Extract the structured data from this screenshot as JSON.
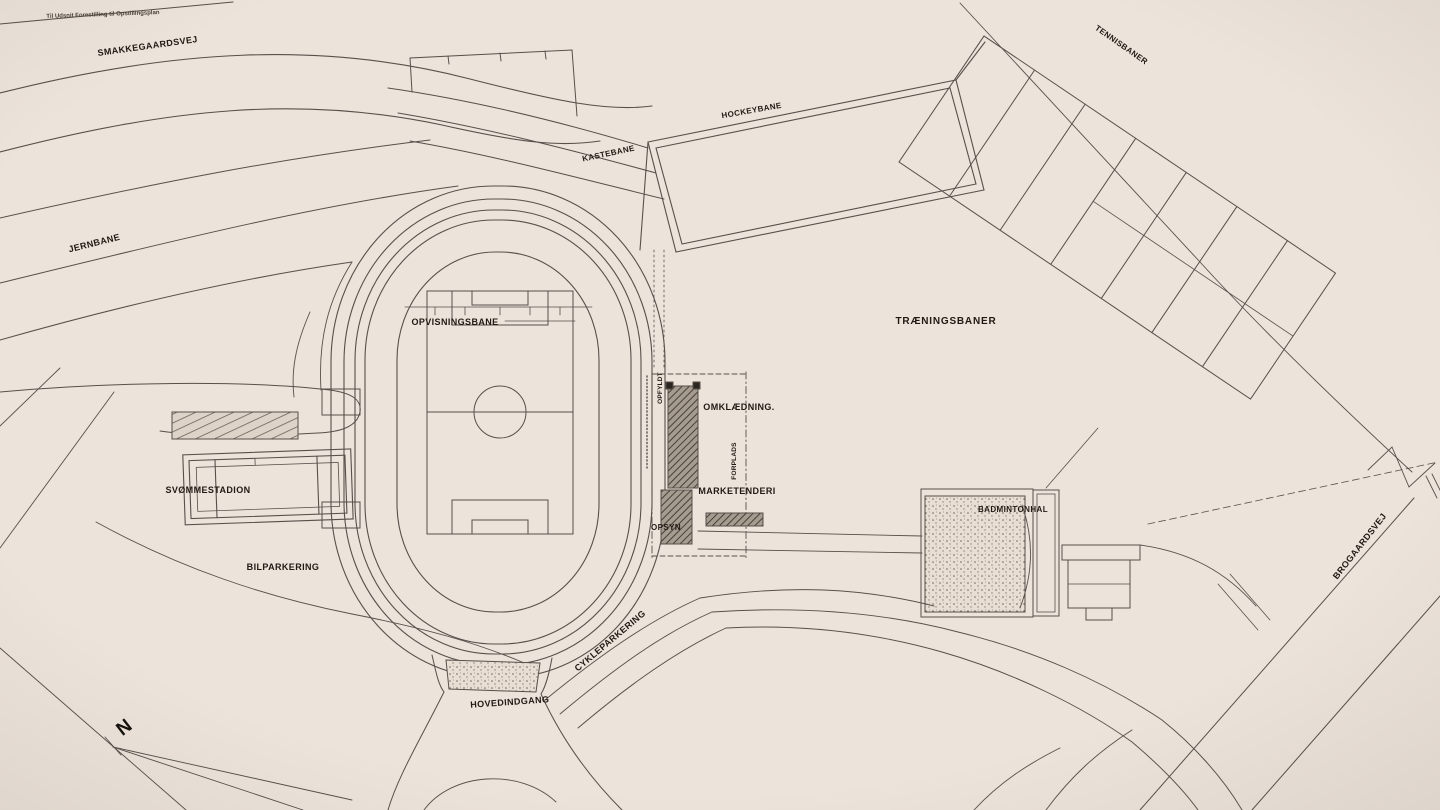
{
  "drawing": {
    "type": "site-plan",
    "caption": "Til Udsnit Forestilling til Opstillingsplan"
  },
  "colors": {
    "paper": "#ece3da",
    "ink": "#57504b",
    "ink_dark": "#201a14",
    "building_fill": "#a59b8f"
  },
  "labels": {
    "smakkegaardsvej": "SMAKKEGAARDSVEJ",
    "jernbane": "JERNBANE",
    "kastebane": "KASTEBANE",
    "hockeybane": "HOCKEYBANE",
    "tennisbaner": "TENNISBANER",
    "opvisningsbane": "OPVISNINGSBANE",
    "traeningsbaner": "TRÆNINGSBANER",
    "omklaedning": "OMKLÆDNING.",
    "marketenderi": "MARKETENDERI",
    "svommestadion": "SVØMMESTADION",
    "bilparkering": "BILPARKERING",
    "opsyn": "OPSYN",
    "badmintonhal": "BADMINTONHAL",
    "cykleparkering": "CYKLEPARKERING",
    "hovedindgang": "HOVEDINDGANG",
    "brogaardsvej": "BROGAARDSVEJ",
    "opfyldt": "OPFYLDT",
    "forplads": "FORPLADS",
    "north": "N"
  }
}
